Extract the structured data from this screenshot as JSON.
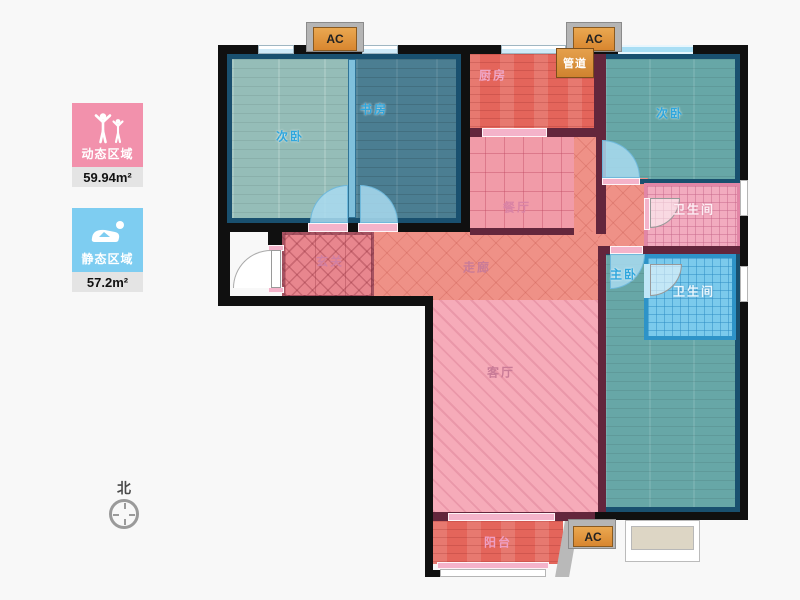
{
  "legend": {
    "dynamic": {
      "label": "动态区域",
      "area": "59.94m²"
    },
    "static": {
      "label": "静态区域",
      "area": "57.2m²"
    }
  },
  "compass": {
    "north_label": "北"
  },
  "ac_units": {
    "top_left": "AC",
    "top_right": "AC",
    "bottom": "AC"
  },
  "rooms": {
    "bedroom_second_left": "次卧",
    "study": "书房",
    "kitchen": "厨房",
    "duct": "管道",
    "bedroom_second_right": "次卧",
    "dining": "餐厅",
    "bathroom_upper": "卫生间",
    "foyer": "玄关",
    "corridor": "走廊",
    "master_bedroom": "主卧",
    "bathroom_lower": "卫生间",
    "living_room": "客厅",
    "balcony": "阳台"
  },
  "colors": {
    "dynamic_card": "#f291ac",
    "static_card": "#7ecdf1",
    "blue_room_label": "#2ea6dd",
    "pink_room_label": "#d07fa2",
    "wall_exterior": "#101010",
    "wall_interior": "#63263c",
    "room_border": "#19506f"
  }
}
